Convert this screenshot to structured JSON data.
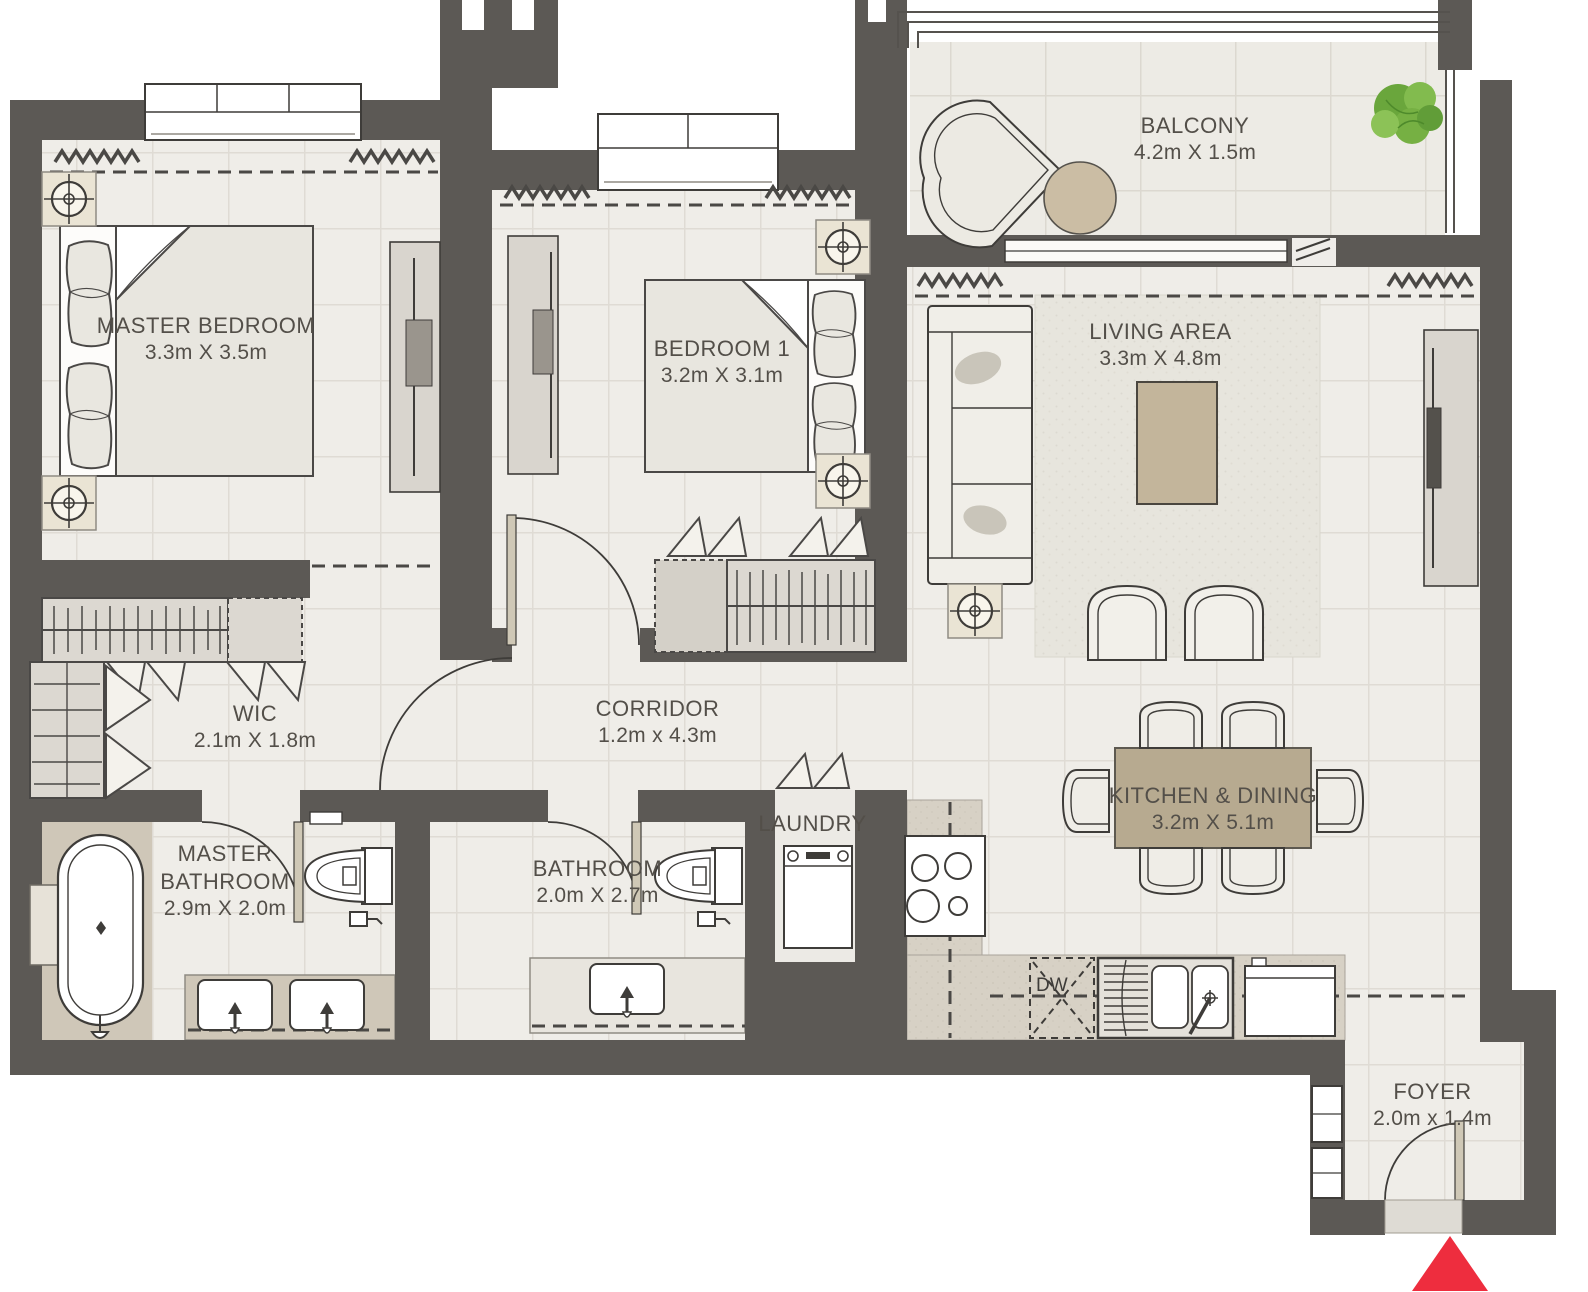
{
  "plan": {
    "rooms": [
      {
        "id": "master-bedroom",
        "name": "MASTER BEDROOM",
        "dims": "3.3m X 3.5m"
      },
      {
        "id": "bedroom-1",
        "name": "BEDROOM 1",
        "dims": "3.2m X 3.1m"
      },
      {
        "id": "living-area",
        "name": "LIVING AREA",
        "dims": "3.3m X 4.8m"
      },
      {
        "id": "balcony",
        "name": "BALCONY",
        "dims": "4.2m X 1.5m"
      },
      {
        "id": "wic",
        "name": "WIC",
        "dims": "2.1m X 1.8m"
      },
      {
        "id": "corridor",
        "name": "CORRIDOR",
        "dims": "1.2m x 4.3m"
      },
      {
        "id": "master-bathroom",
        "name": "MASTER BATHROOM",
        "dims": "2.9m X 2.0m"
      },
      {
        "id": "bathroom",
        "name": "BATHROOM",
        "dims": "2.0m X 2.7m"
      },
      {
        "id": "laundry",
        "name": "LAUNDRY",
        "dims": ""
      },
      {
        "id": "kitchen-dining",
        "name": "KITCHEN & DINING",
        "dims": "3.2m X 5.1m"
      },
      {
        "id": "foyer",
        "name": "FOYER",
        "dims": "2.0m x 1.4m"
      }
    ],
    "appliance_labels": {
      "dishwasher": "DW"
    },
    "colors": {
      "wall": "#5c5955",
      "floor": "#efede8",
      "accent_tan": "#b7aa90",
      "entry_arrow": "#ee2d3e",
      "plant_green": "#76b043"
    }
  }
}
